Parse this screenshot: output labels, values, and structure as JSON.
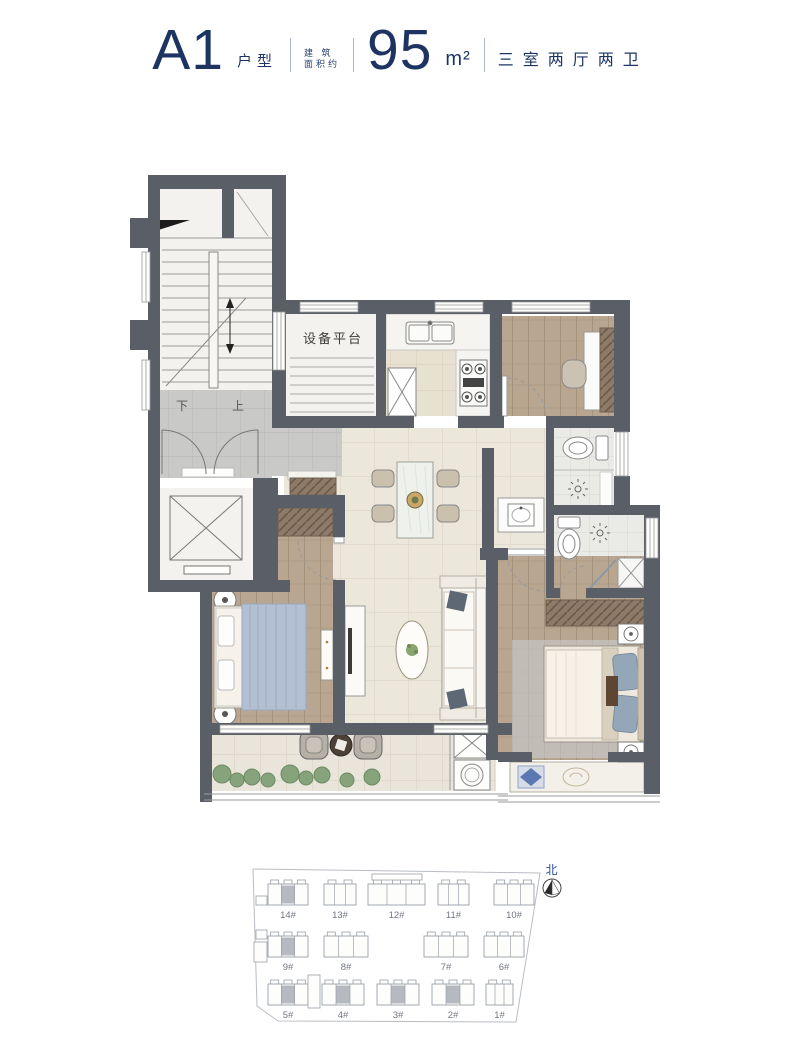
{
  "header": {
    "unit_code": "A1",
    "unit_type_label": "户型",
    "area_prefix_line1": "建 筑",
    "area_prefix_line2": "面积约",
    "area_value": "95",
    "area_unit": "m²",
    "rooms_summary": "三室两厅两卫",
    "text_color": "#1d3463"
  },
  "floor_plan": {
    "equipment_platform_label": "设备平台",
    "stairs_down_label": "下",
    "stairs_up_label": "上",
    "colors": {
      "wall": "#5a5e66",
      "wood_floor": "#b9a690",
      "tile_floor": "#ece7db",
      "landing_floor": "#c9c9c7",
      "bath_floor": "#eaebe7",
      "wardrobe": "#8d7a68",
      "plant": "#87a37c",
      "rug_blue": "#93a7b8"
    }
  },
  "site_plan": {
    "north_label": "北",
    "buildings": [
      {
        "label": "14#",
        "highlighted": true
      },
      {
        "label": "13#",
        "highlighted": false
      },
      {
        "label": "12#",
        "highlighted": false
      },
      {
        "label": "11#",
        "highlighted": false
      },
      {
        "label": "10#",
        "highlighted": false
      },
      {
        "label": "9#",
        "highlighted": true
      },
      {
        "label": "8#",
        "highlighted": false
      },
      {
        "label": "7#",
        "highlighted": false
      },
      {
        "label": "6#",
        "highlighted": false
      },
      {
        "label": "5#",
        "highlighted": true
      },
      {
        "label": "4#",
        "highlighted": true
      },
      {
        "label": "3#",
        "highlighted": true
      },
      {
        "label": "2#",
        "highlighted": true
      },
      {
        "label": "1#",
        "highlighted": false
      }
    ]
  }
}
